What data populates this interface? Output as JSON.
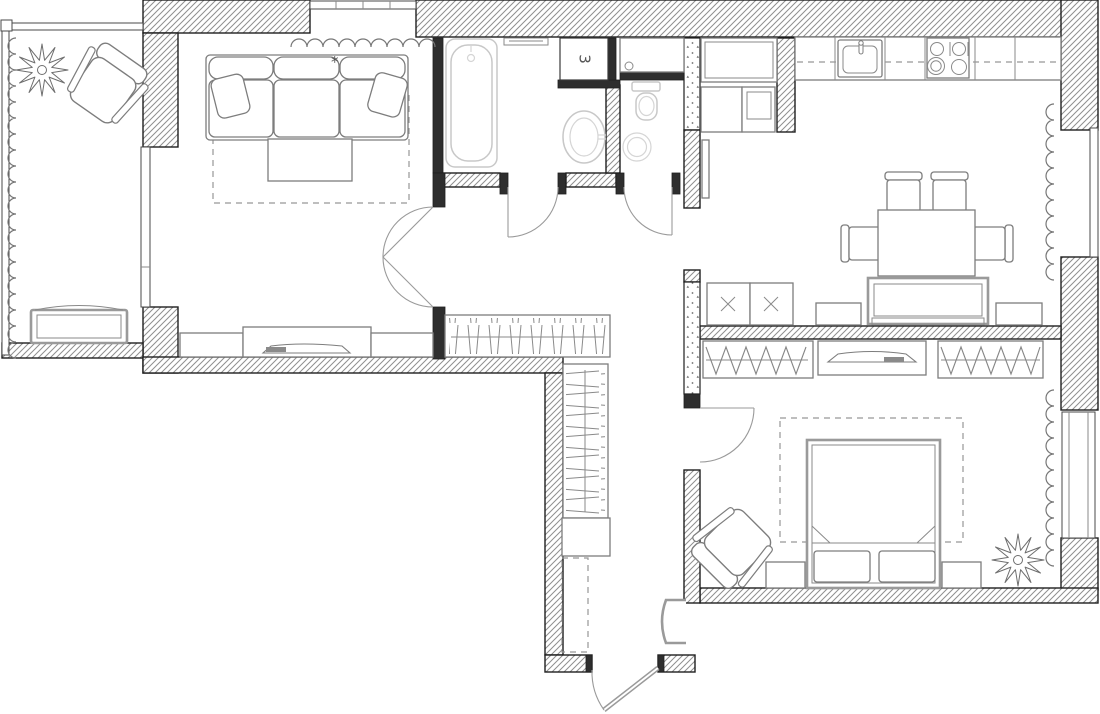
{
  "floorplan": {
    "niche_label": "3",
    "sofa_marker": "*",
    "colors": {
      "background": "#ffffff",
      "wall_fill": "#2e2e2e",
      "hatch_line": "#8f8f8f",
      "furniture_stroke": "#7d7d7d",
      "upholstery_stroke": "#9a9a9a",
      "sanitary_faded": "#c8c8c8",
      "dash_line": "#979797"
    }
  }
}
